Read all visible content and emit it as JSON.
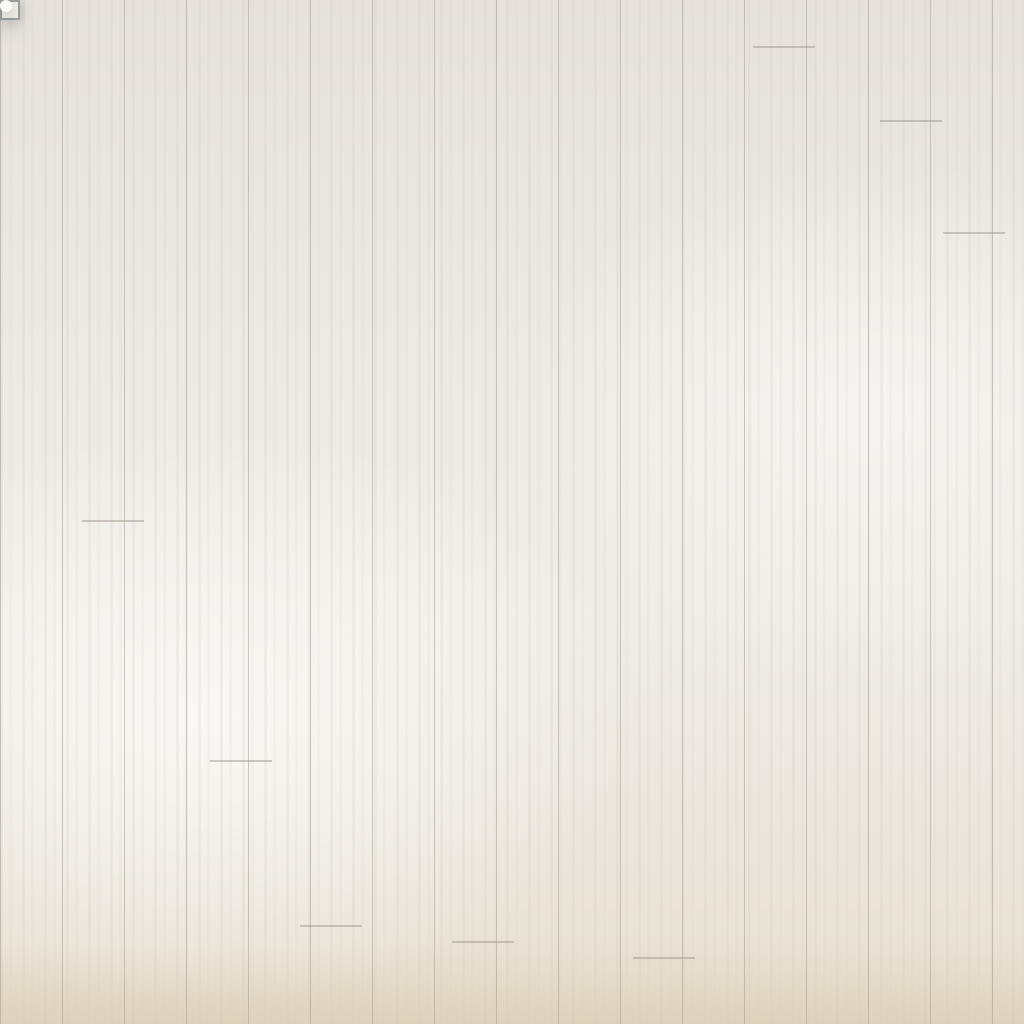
{
  "scene": {
    "type": "product-photo",
    "subject": "Top view of a beige distressed-texture area rug with dark brown geometric fret border, staged in a living room",
    "view": "overhead"
  },
  "objects": {
    "sofa": {
      "label": "beige L-shaped sectional sofa"
    },
    "pillows": [
      {
        "label": "dark brown velvet cushion"
      },
      {
        "label": "blue, white and brown houndstooth striped cushion"
      }
    ],
    "plant": {
      "label": "green palm fronds"
    },
    "floor": {
      "label": "whitewashed wood plank floor"
    },
    "rug": {
      "label": "beige crosshatch-distressed rug",
      "border_style": "dark brown interlocking square fret corners with double key lines",
      "edge": "white selvage binding"
    },
    "detail_inset": {
      "label": "magnified circle showing folded rug corner with dotted anti-slip backing and fringe"
    }
  },
  "palette": {
    "rug_tan": "#b79b73",
    "rug_wash": "#f0eadb",
    "rug_border": "#452f18",
    "rug_edge_white": "#f4f1e8",
    "sofa_beige": "#cbb5a6",
    "sofa_back": "#d8c5b7",
    "pillow_brown": "#4a3423",
    "pillow_blue": "#4e7e9a",
    "backing_gray": "#dfe2d9",
    "floor_white": "#eceae3",
    "shadow_gray": "#3c424c",
    "palm_greens": [
      "#2e6c2e",
      "#3a7a36",
      "#4a8c3f",
      "#57994a",
      "#6ba355"
    ]
  },
  "layout_joints": [
    [
      753,
      46
    ],
    [
      943,
      232
    ],
    [
      82,
      520
    ],
    [
      300,
      925
    ],
    [
      452,
      941
    ],
    [
      633,
      957
    ],
    [
      880,
      120
    ],
    [
      210,
      760
    ]
  ]
}
